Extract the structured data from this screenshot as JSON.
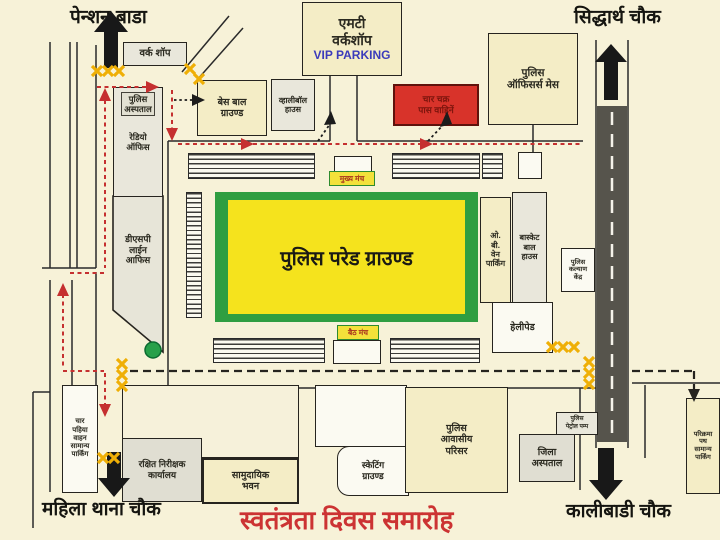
{
  "title": "स्वतंत्रता दिवस समारोह",
  "corners": {
    "top_left": "पेन्शन बाडा",
    "top_right": "सिद्धार्थ चौक",
    "bottom_left": "महिला थाना चौक",
    "bottom_right": "कालीबाडी चौक"
  },
  "vip_block": {
    "line1": "एमटी",
    "line2": "वर्कशॉप",
    "line3": "VIP PARKING"
  },
  "buildings": {
    "work_shop": "वर्क शॉप",
    "police_hospital": "पुलिस\nअस्पताल",
    "radio_office": "रेडियो\nऑफिस",
    "dsp_line_office": "डीएसपी\nलाईन\nआफिस",
    "baseball_ground": "बेस बाल\nग्राउण्ड",
    "volleyball_house": "व्हालीबॉल\nहाउस",
    "pass_vehicles": "चार चक्र\nपास वाहिनें",
    "officers_mess": "पुलिस\nऑफिसर्स मेस",
    "parade_ground": "पुलिस परेड ग्राउण्ड",
    "main_stage": "मुख्य मंच",
    "rear_stage": "बैठ मंच",
    "ob_van_parking": "ओ.\nबी.\nवेन\nपार्किंग",
    "basketball_house": "बास्केट\nबाल\nहाउस",
    "police_welfare_centre": "पुलिस\nकल्याण\nकेंद्र",
    "helipad": "हेलीपेड",
    "general_parking_left": "चार\nपहिया\nवाहन\nसामान्य\nपार्किंग",
    "reserve_inspector_office": "रक्षित निरीक्षक\nकार्यालय",
    "community_building": "सामुदायिक\nभवन",
    "skating_ground": "स्केटिंग\nग्राउण्ड",
    "police_residential": "पुलिस\nआवासीय\nपरिसर",
    "district_hospital": "जिला\nअस्पताल",
    "police_petrol_pump": "पुलिस\nपेट्रोल पम्प",
    "parikrama_parking": "परिक्रमा\nपथ\nसामान्य\nपार्किंग"
  },
  "colors": {
    "background": "#f7f2d8",
    "parade_border_green": "#2f9e41",
    "parade_fill_yellow": "#f5e31d",
    "stage_label_yellow": "#f3e13a",
    "restricted_red_box": "#d8332a",
    "route_red": "#c53030",
    "barrier_yellow": "#efaf06",
    "road_dark": "#56544c",
    "title_red": "#cc3333",
    "vip_blue": "#3b3bbb",
    "tree_green": "#27a04a"
  }
}
